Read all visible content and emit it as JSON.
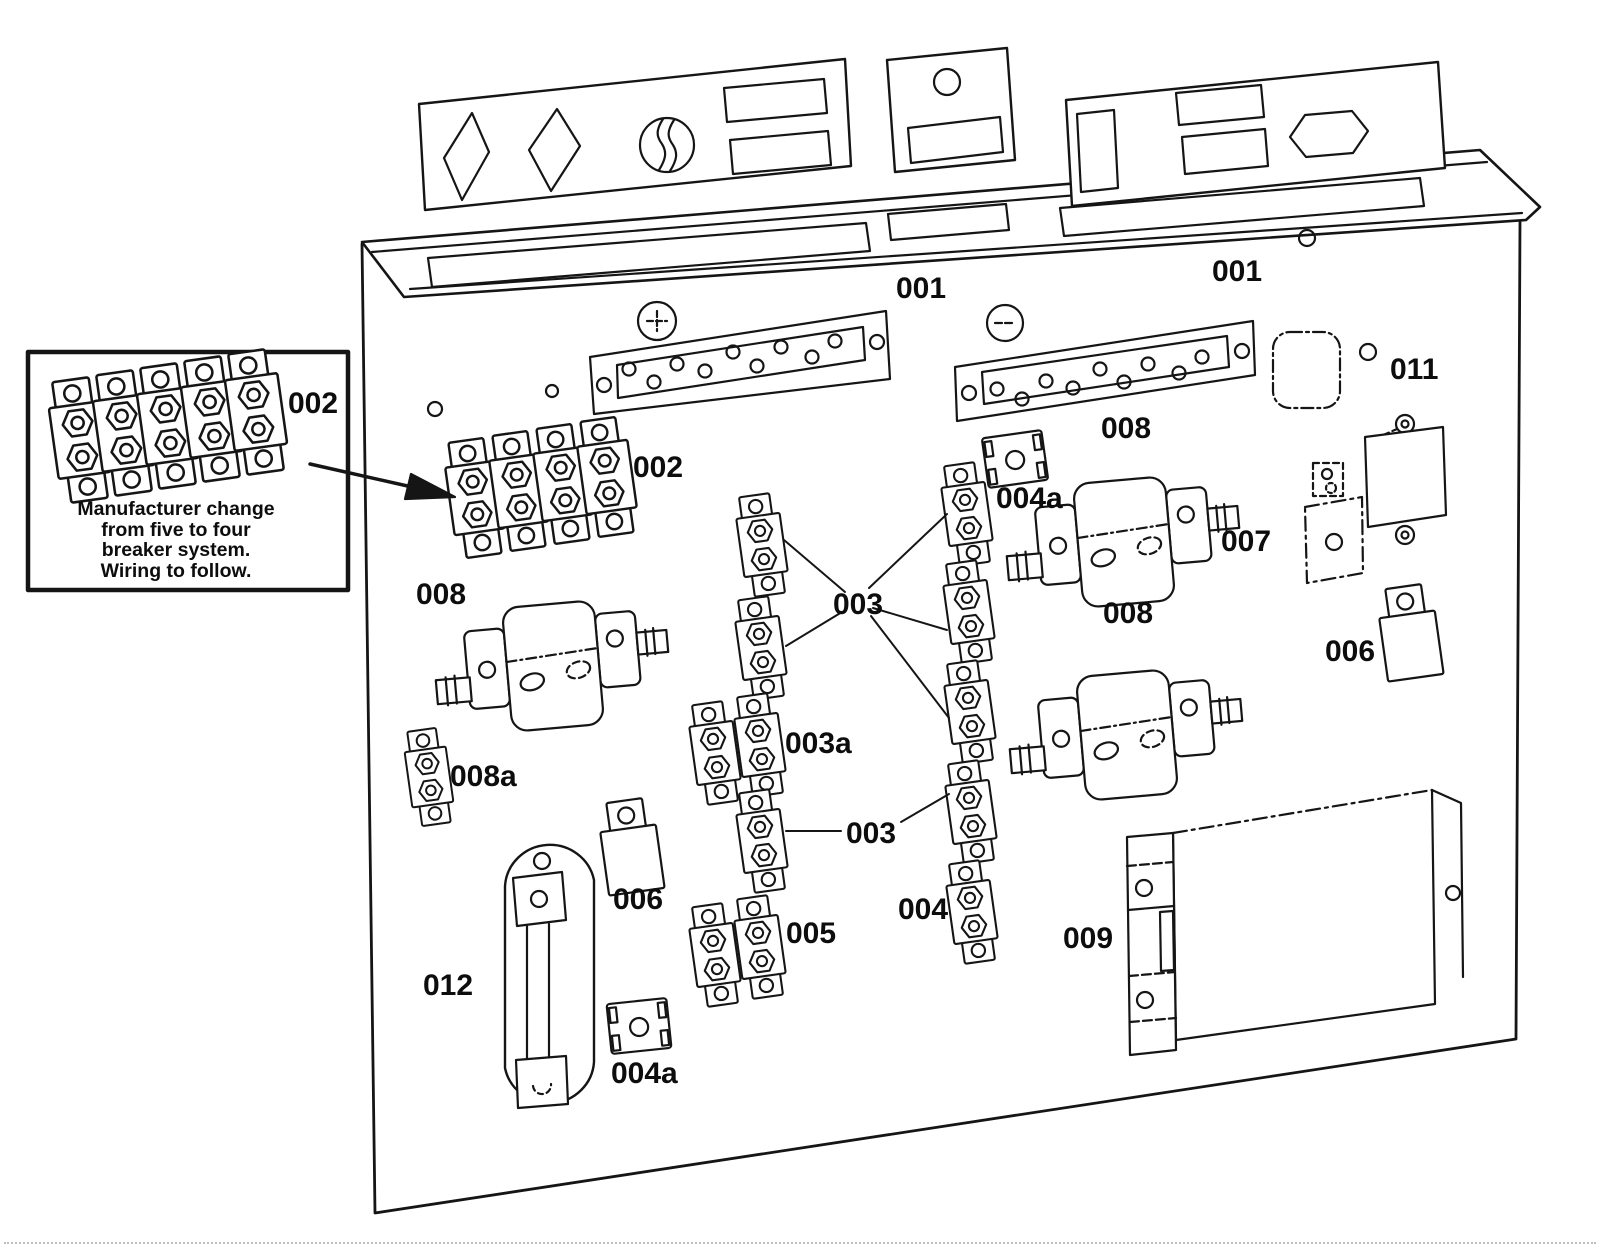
{
  "figure": {
    "kind": "exploded-parts-diagram",
    "subject": "Electrical back panel assembly with numbered part callouts"
  },
  "inset_note": {
    "label": "002",
    "text": "Manufacturer change\nfrom five to four\nbreaker system.\nWiring to follow."
  },
  "labels": {
    "panel_top_center": "001",
    "panel_top_right": "001",
    "hole_011": "011",
    "breaker_bank_main": "002",
    "contactor_left": "008",
    "bus_bar_right": "008",
    "bracket_top_004a": "004a",
    "plate_007": "007",
    "contactor_right": "008",
    "relay_right_006": "006",
    "breakers_center_upper": "003",
    "breaker_pair_003a": "003a",
    "breakers_center_lower": "003",
    "breaker_pair_005": "005",
    "breaker_column_004": "004",
    "relay_left_006": "006",
    "link_012": "012",
    "bracket_bottom_004a": "004a",
    "cover_009": "009",
    "fuse_008a": "008a"
  }
}
